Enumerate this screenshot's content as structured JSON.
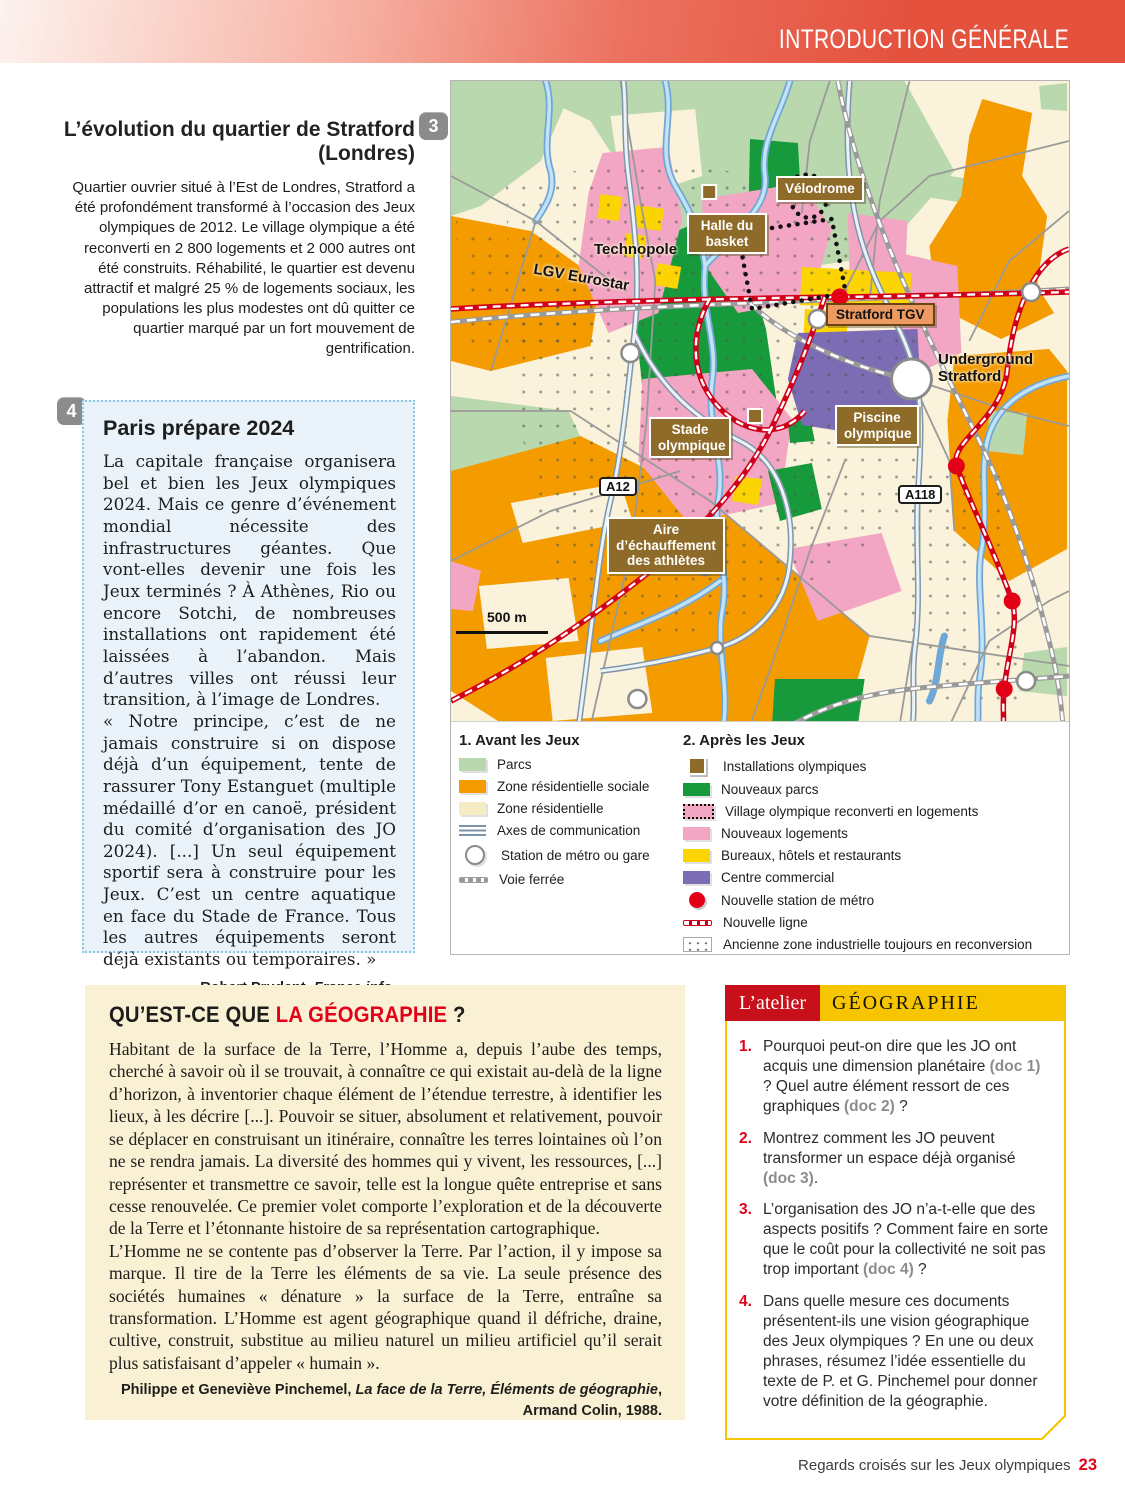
{
  "header": {
    "title": "INTRODUCTION GÉNÉRALE"
  },
  "doc3": {
    "number": "3",
    "title": "L’évolution du quartier de Stratford (Londres)",
    "body": "Quartier ouvrier situé à l’Est de Londres, Stratford a été profondément transformé à l’occasion des Jeux olympiques de 2012. Le village olympique a été reconverti en 2 800 logements et 2 000 autres ont été construits. Réhabilité, le quartier est devenu attractif et malgré 25 % de logements sociaux, les populations les plus modestes ont dû quitter ce quartier marqué par un fort mouvement de gentrification."
  },
  "doc4": {
    "number": "4",
    "title": "Paris prépare 2024",
    "body": "La capitale française organisera bel et bien les Jeux olympiques 2024. Mais ce genre d’événement mondial nécessite des infrastructures géantes. Que vont-elles devenir une fois les Jeux terminés ? À Athènes, Rio ou encore Sotchi, de nombreuses installations ont rapidement été laissées à l’abandon. Mais d’autres villes ont réussi leur transition, à l’image de Londres.\n« Notre principe, c’est de ne jamais construire si on dispose déjà d’un équipement, tente de rassurer Tony Estanguet (multiple médaillé d’or en canoë, président du comité d’organisation des JO 2024). [...] Un seul équipement sportif sera à construire pour les Jeux. C’est un centre aquatique en face du Stade de France. Tous les autres équipements seront déjà existants ou temporaires. »",
    "attrib_pre": "Robert Prudent, ",
    "attrib_source": "France info",
    "attrib_post": ",",
    "attrib_line2": "13 septembre 2017."
  },
  "map": {
    "labels": {
      "velodrome": "Vélodrome",
      "halle": "Halle du basket",
      "technopole": "Technopole",
      "lgv": "LGV Eurostar",
      "stratford_tgv": "Stratford TGV",
      "underground": "Underground Stratford",
      "stade": "Stade olympique",
      "piscine": "Piscine olympique",
      "a12": "A12",
      "a118": "A118",
      "aire": "Aire d’échauffement des athlètes",
      "scale": "500 m"
    }
  },
  "legend": {
    "avant": {
      "title": "1. Avant les Jeux",
      "items": [
        {
          "label": "Parcs"
        },
        {
          "label": "Zone résidentielle sociale"
        },
        {
          "label": "Zone résidentielle"
        },
        {
          "label": "Axes de communication"
        },
        {
          "label": "Station de métro ou gare"
        },
        {
          "label": "Voie ferrée"
        }
      ]
    },
    "apres": {
      "title": "2. Après les Jeux",
      "items": [
        {
          "label": "Installations olympiques"
        },
        {
          "label": "Nouveaux parcs"
        },
        {
          "label": "Village olympique reconverti en logements"
        },
        {
          "label": "Nouveaux logements"
        },
        {
          "label": "Bureaux, hôtels et restaurants"
        },
        {
          "label": "Centre commercial"
        },
        {
          "label": "Nouvelle station de métro"
        },
        {
          "label": "Nouvelle ligne"
        },
        {
          "label": "Ancienne zone industrielle toujours en reconversion"
        }
      ]
    }
  },
  "geo": {
    "title_black": "QU’EST-CE QUE ",
    "title_red": "LA GÉOGRAPHIE",
    "title_end": " ?",
    "para1": "Habitant de la surface de la Terre, l’Homme a, depuis l’aube des temps, cherché à savoir où il se trouvait, à connaître ce qui existait au-delà de la ligne d’horizon, à inventorier chaque élément de l’étendue terrestre, à identifier les lieux, à les décrire [...]. Pouvoir se situer, absolument et relativement, pouvoir se déplacer en construisant un itinéraire, connaître les terres lointaines où l’on ne se rendra jamais. La diversité des hommes qui y vivent, les ressources, [...] représenter et transmettre ce savoir, telle est la longue quête entreprise et sans cesse renouvelée. Ce premier volet comporte l’exploration et de la découverte de la Terre et l’étonnante histoire de sa représentation cartographique.",
    "para2": "L’Homme ne se contente pas d’observer la Terre. Par l’action, il y impose sa marque. Il tire de la Terre les éléments de sa vie. La seule présence des sociétés humaines « dénature » la surface de la Terre, entraîne sa transformation. L’Homme est agent géographique quand il défriche, draine, cultive, construit, substitue au milieu naturel un milieu artificiel qu’il serait plus satisfaisant d’appeler « humain ».",
    "attrib_pre": "Philippe et Geneviève Pinchemel, ",
    "attrib_title": "La face de la Terre, Éléments de géographie",
    "attrib_post": ", Armand Colin, 1988."
  },
  "atelier": {
    "label": "L’atelier",
    "subject": "GÉOGRAPHIE",
    "questions": [
      {
        "num": "1.",
        "s0": "Pourquoi peut-on dire que les JO ont acquis une dimension planétaire ",
        "g0": "(doc 1)",
        "s1": " ? Quel autre élément ressort de ces graphiques ",
        "g1": "(doc 2)",
        "s2": " ?"
      },
      {
        "num": "2.",
        "s0": "Montrez comment les JO peuvent transformer un espace déjà organisé ",
        "g0": "(doc 3)",
        "s1": "."
      },
      {
        "num": "3.",
        "s0": "L’organisation des JO n’a-t-elle que des aspects positifs ? Comment faire en sorte que le coût pour la collectivité ne soit pas trop important ",
        "g0": "(doc 4)",
        "s1": " ?"
      },
      {
        "num": "4.",
        "s0": "Dans quelle mesure ces documents présentent-ils une vision géographique des Jeux olympiques ? En une ou deux phrases, résumez l’idée essentielle du texte de P. et G. Pinchemel pour donner votre définition de la géographie."
      }
    ]
  },
  "footer": {
    "text": "Regards croisés sur les Jeux olympiques",
    "page": "23"
  },
  "colors": {
    "accent_red": "#e2001a",
    "header_red": "#e4523e",
    "atelier_red": "#c8101b",
    "atelier_yellow": "#f6c500",
    "doc_box_blue": "#eaf3fa",
    "geo_box_cream": "#faf1d4",
    "map_beige": "#faf2da",
    "map_parcs_green": "#b9d8ae",
    "map_new_parks_green": "#169a3c",
    "map_orange": "#f49b00",
    "map_pink": "#f2a6c3",
    "map_yellow": "#fcd303",
    "map_purple": "#7b6cb4",
    "map_brown": "#8f6b29",
    "new_line_red": "#d1001a"
  }
}
